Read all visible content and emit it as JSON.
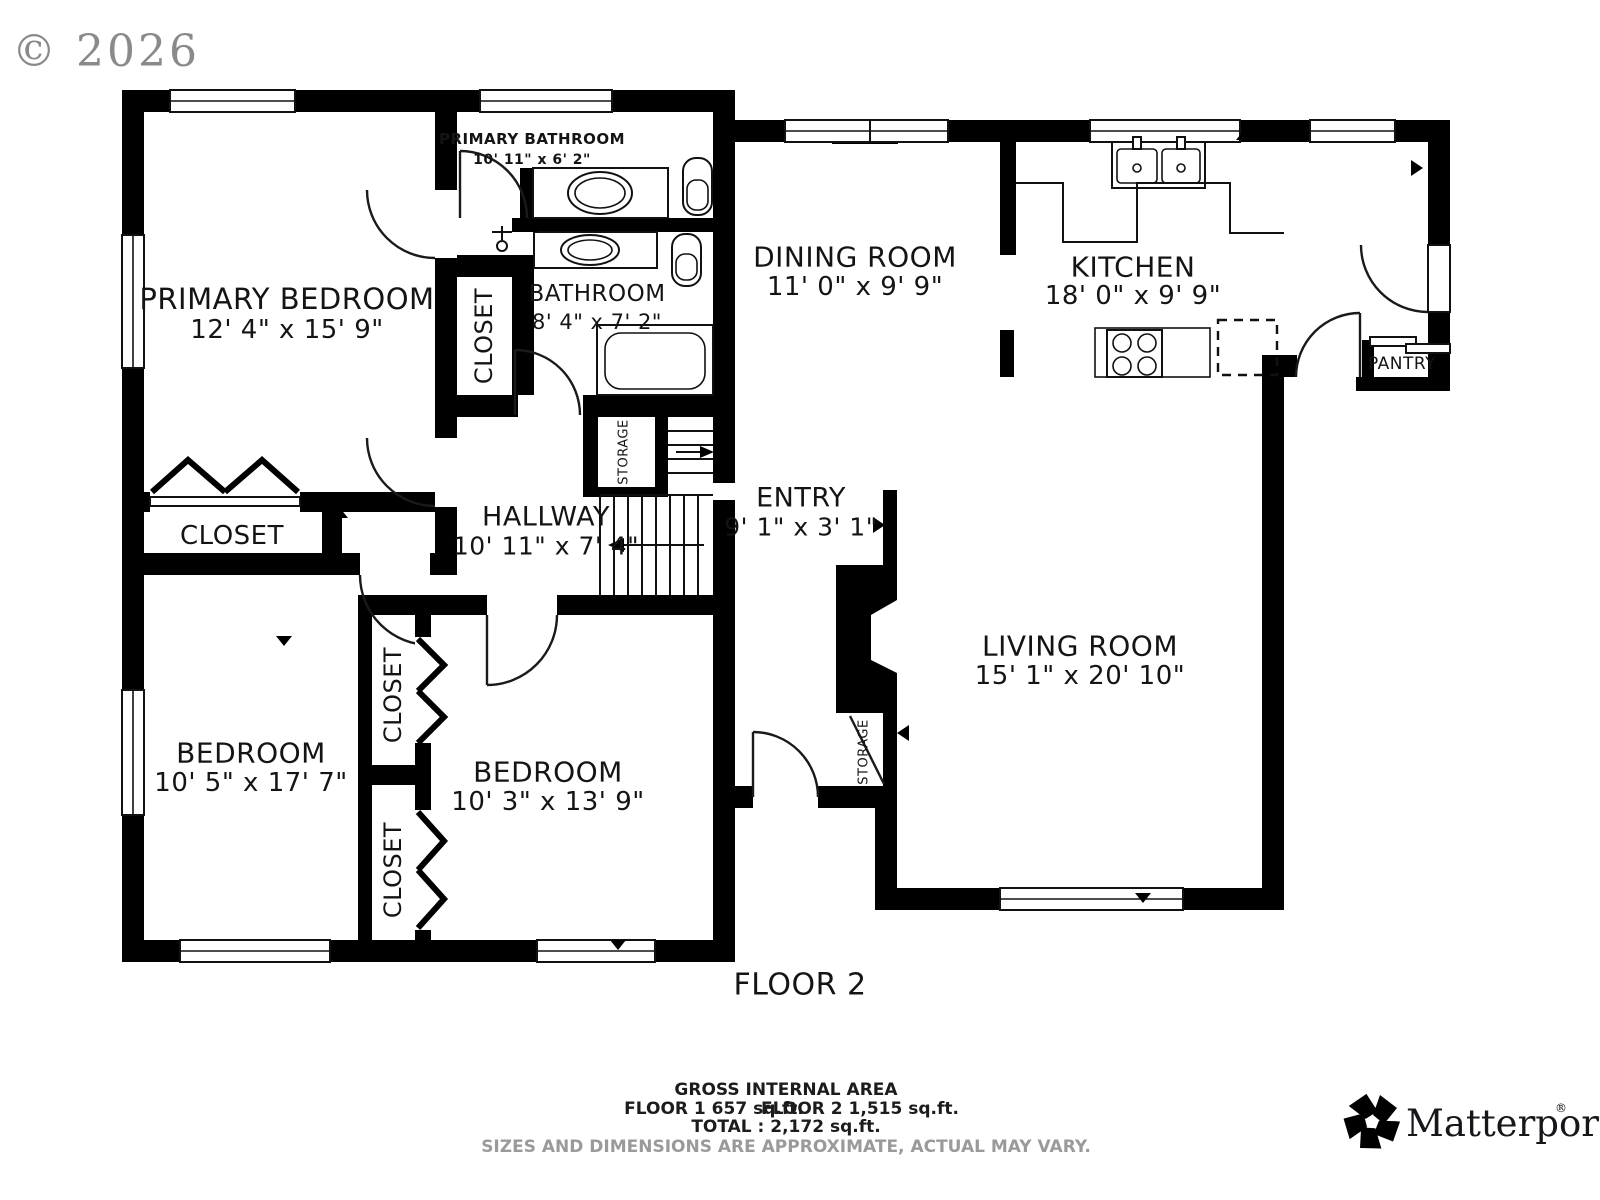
{
  "watermark": "© 2026",
  "floor_label": "FLOOR 2",
  "rooms": {
    "primary_bedroom": {
      "name": "PRIMARY BEDROOM",
      "dims": "12' 4\" x 15' 9\""
    },
    "primary_bathroom": {
      "name": "PRIMARY BATHROOM",
      "dims": "10' 11\" x 6' 2\""
    },
    "bathroom": {
      "name": "BATHROOM",
      "dims": "8' 4\" x 7' 2\""
    },
    "dining_room": {
      "name": "DINING ROOM",
      "dims": "11' 0\" x 9' 9\""
    },
    "kitchen": {
      "name": "KITCHEN",
      "dims": "18' 0\" x 9' 9\""
    },
    "pantry": {
      "name": "PANTRY"
    },
    "entry": {
      "name": "ENTRY",
      "dims": "9' 1\" x 3' 1\""
    },
    "hallway": {
      "name": "HALLWAY",
      "dims": "10' 11\" x 7' 4\""
    },
    "living_room": {
      "name": "LIVING ROOM",
      "dims": "15' 1\" x 20' 10\""
    },
    "bedroom_left": {
      "name": "BEDROOM",
      "dims": "10' 5\" x 17' 7\""
    },
    "bedroom_center": {
      "name": "BEDROOM",
      "dims": "10' 3\" x 13' 9\""
    }
  },
  "labels": {
    "closet": "CLOSET",
    "storage": "STORAGE"
  },
  "footer": {
    "gross_title": "GROSS INTERNAL AREA",
    "floor1": "FLOOR 1 657 sq.ft.",
    "floor2": "FLOOR 2 1,515 sq.ft.",
    "total": "TOTAL :  2,172 sq.ft.",
    "disclaimer": "SIZES AND DIMENSIONS ARE APPROXIMATE, ACTUAL MAY VARY."
  },
  "brand": {
    "name": "Matterport",
    "mark": "®"
  },
  "colors": {
    "wall": "#000000",
    "text": "#141414",
    "muted": "#9a9a9a",
    "watermark": "#8a8a8a",
    "background": "#ffffff"
  }
}
